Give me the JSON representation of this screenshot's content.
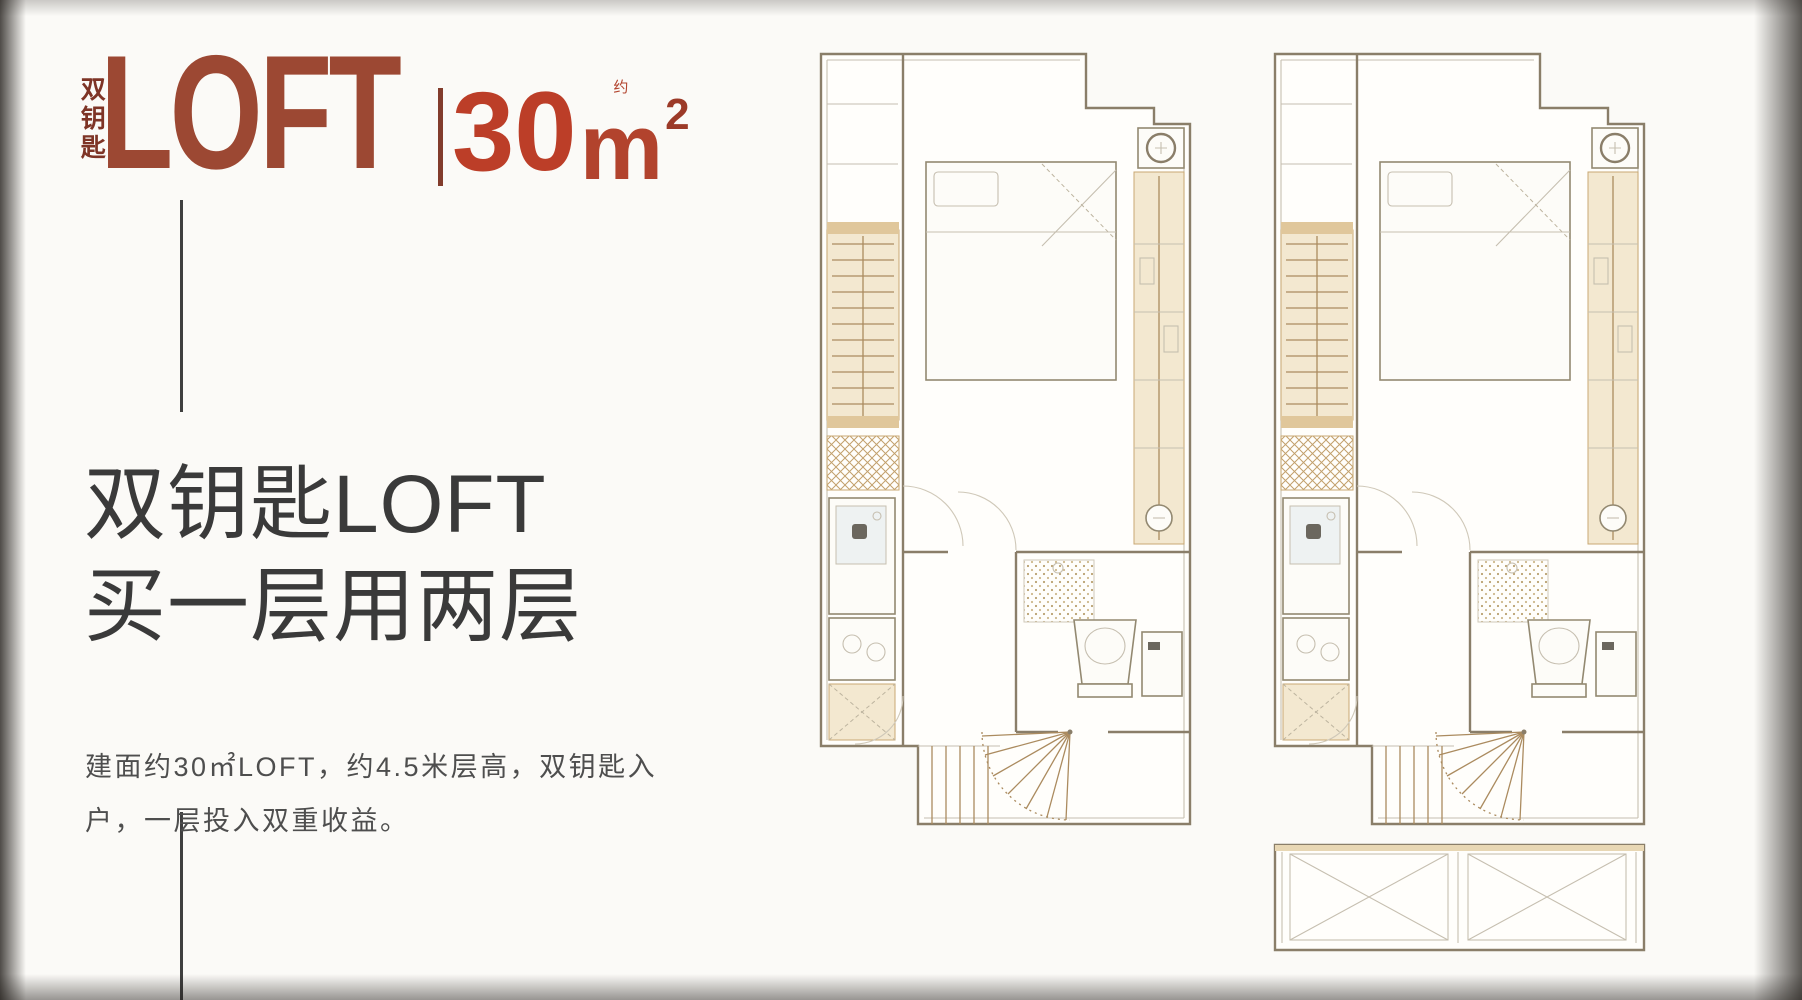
{
  "brand": {
    "vertical_label": "双钥匙",
    "loft": "LOFT",
    "area_number": "30",
    "area_approx": "约",
    "area_unit": "m",
    "area_sup": "2"
  },
  "headline": {
    "line1": "双钥匙LOFT",
    "line2": "买一层用两层"
  },
  "description": {
    "line1": "建面约30㎡LOFT，约4.5米层高，双钥匙入",
    "line2": "户，一层投入双重收益。"
  },
  "plans": {
    "left_plan_label": "floor-plan-left",
    "right_plan_label": "floor-plan-right",
    "elements": [
      "bed",
      "wardrobe",
      "closet-ladder",
      "entry-mat",
      "kitchen-sink",
      "cooktop",
      "shoe-cabinet",
      "shower",
      "toilet",
      "vanity",
      "spiral-staircase",
      "straight-stairs",
      "ac-unit",
      "balcony"
    ]
  },
  "colors": {
    "brand_red": "#9c4833",
    "brand_red_dark": "#7e3426",
    "area_red": "#bc3e28",
    "heading": "#3a3a3a",
    "body_text": "#4e4e4e",
    "line": "#3f3f3f",
    "plan_wall": "#8a7e69",
    "plan_light": "#c6bfb0",
    "plan_tan": "#f3e8d0",
    "plan_tan_dark": "#e0c79b",
    "plan_hatch": "#ab8b5f"
  }
}
